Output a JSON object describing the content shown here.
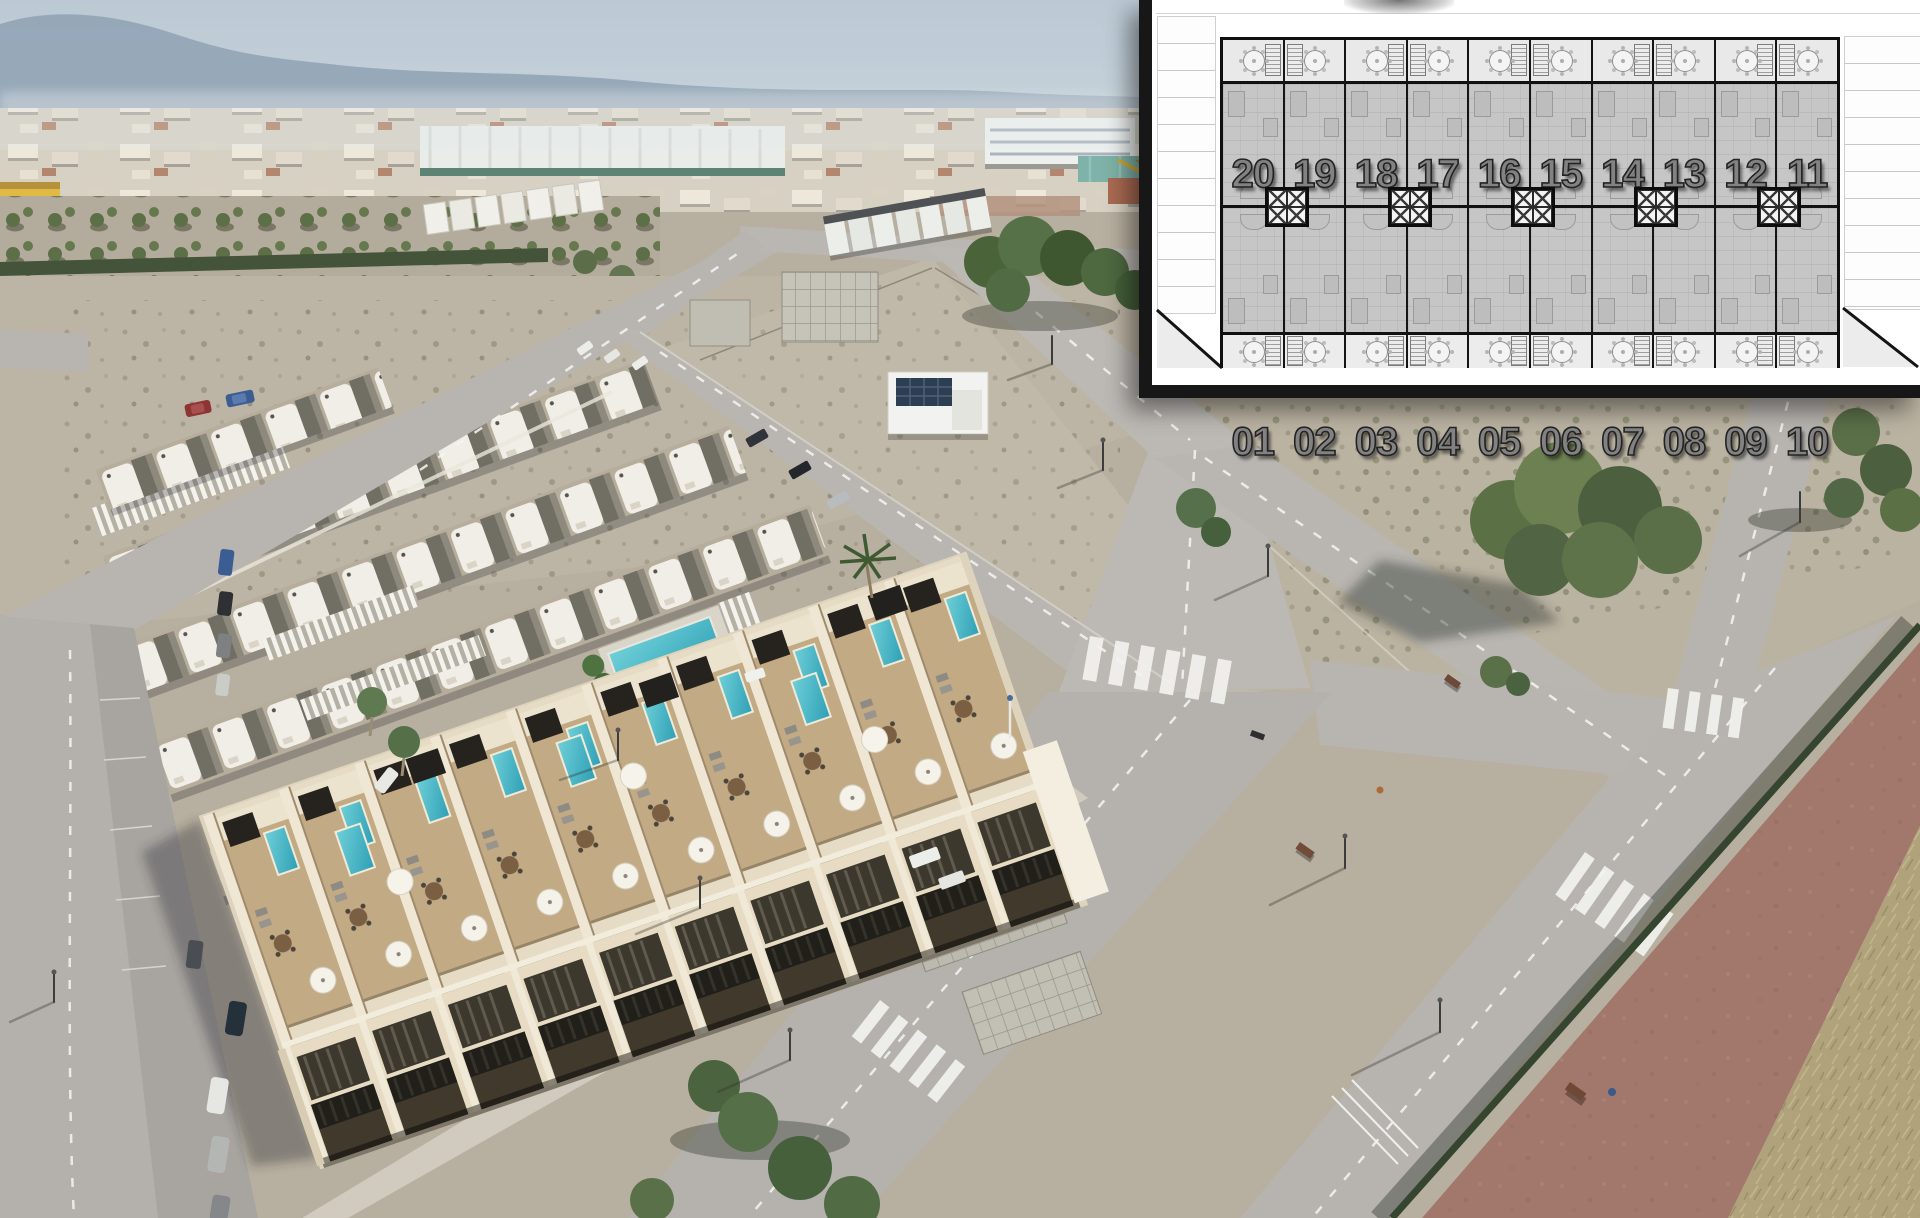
{
  "overlay_plan": {
    "units_top": [
      "20",
      "19",
      "18",
      "17",
      "16",
      "15",
      "14",
      "13",
      "12",
      "11"
    ],
    "units_bottom": [
      "01",
      "02",
      "03",
      "04",
      "05",
      "06",
      "07",
      "08",
      "09",
      "10"
    ],
    "shaft_count": 5,
    "icons": {
      "table": "round-table-icon",
      "stairs": "stairs-icon",
      "shaft": "elevator-shaft-icon"
    },
    "colors": {
      "panel_bg": "#ffffff",
      "border": "#171717",
      "terrace": "#e9e9e9",
      "unit_fill": "#c6c6c6",
      "number_fill": "#828282",
      "number_outline": "#232323"
    }
  },
  "scene": {
    "palette": {
      "sky": "#b2c1ce",
      "mountains": "#7e93a7",
      "town": "#d7d1c3",
      "dirt": "#b7af9f",
      "road": "#b6b3ae",
      "orchard_green": "#5d6f47",
      "hedge_green": "#44543a",
      "communal_pool": "#2f97a0",
      "plunge_pool": "#3fb9c9",
      "render_building_cream": "#e9dfc8",
      "render_deck_tan": "#c2aa84",
      "pergola_dark": "#26231e",
      "bike_path_red": "#a3786c",
      "dry_grass": "#b0a37c",
      "crane_yellow": "#caa83d",
      "warehouse_green": "#5d8374",
      "yellow_building": "#e0ba45"
    }
  }
}
